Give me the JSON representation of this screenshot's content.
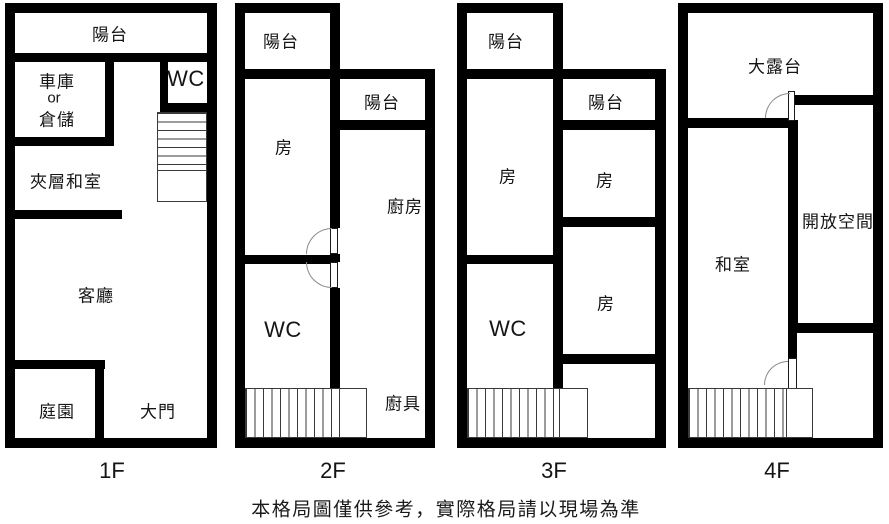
{
  "page": {
    "background": "#ffffff",
    "wall_color": "#000000",
    "disclaimer": "本格局圖僅供參考，實際格局請以現場為準"
  },
  "floors": [
    {
      "label": "1F",
      "rooms": {
        "balcony": "陽台",
        "garage_line1": "車庫",
        "garage_line2": "or",
        "garage_line3": "倉儲",
        "wc": "WC",
        "mezzanine": "夾層和室",
        "living_room": "客廳",
        "garden": "庭園",
        "main_entrance": "大門"
      }
    },
    {
      "label": "2F",
      "rooms": {
        "balcony_front": "陽台",
        "balcony_side": "陽台",
        "bedroom": "房",
        "kitchen": "廚房",
        "wc": "WC",
        "kitchen_counter": "廚具"
      }
    },
    {
      "label": "3F",
      "rooms": {
        "balcony_front": "陽台",
        "balcony_side": "陽台",
        "bedroom_left": "房",
        "bedroom_right_upper": "房",
        "bedroom_right_lower": "房",
        "wc": "WC"
      }
    },
    {
      "label": "4F",
      "rooms": {
        "terrace": "大露台",
        "tatami_room": "和室",
        "open_space": "開放空間"
      }
    }
  ]
}
